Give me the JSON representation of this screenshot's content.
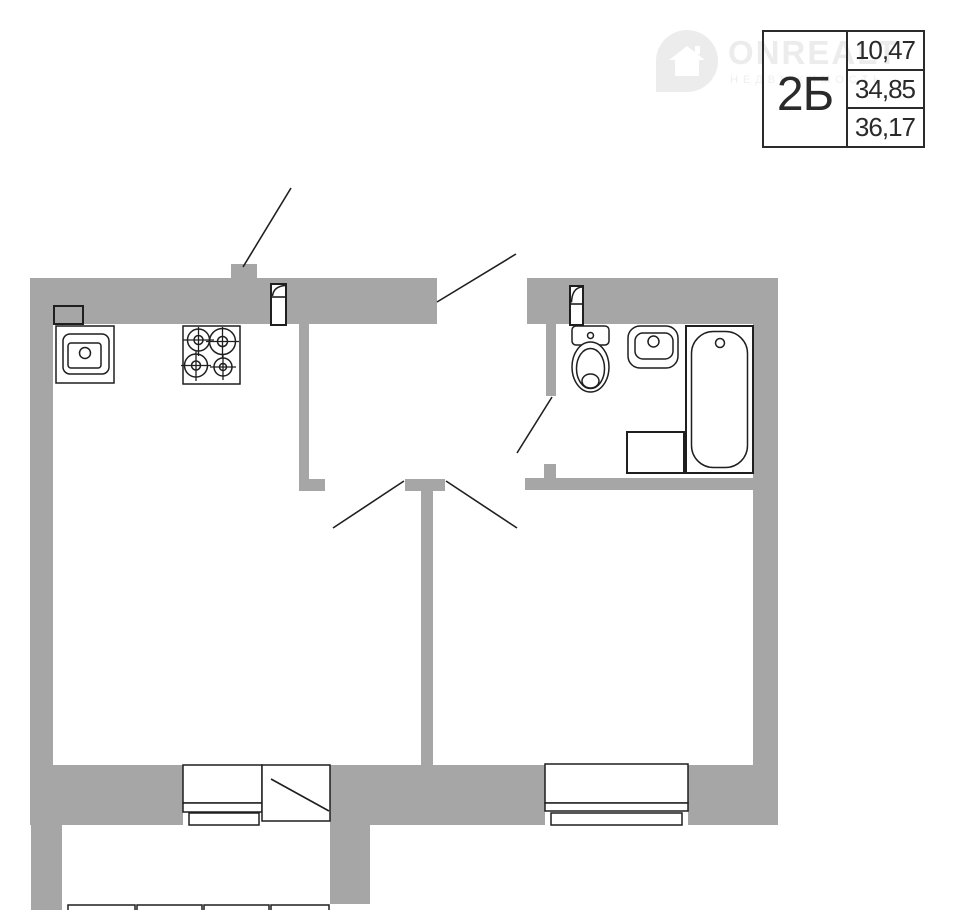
{
  "watermark": {
    "brand": "ONREALT",
    "subtitle": "НЕДВИЖИМОСТЬ"
  },
  "info_table": {
    "unit_label": "2Б",
    "areas": [
      "10,47",
      "34,85",
      "36,17"
    ]
  },
  "colors": {
    "wall": "#a6a6a6",
    "outline": "#1f1f1f",
    "watermark": "#ececec",
    "background": "#ffffff",
    "text": "#2a2a2a"
  },
  "fixtures": [
    "vent-duct",
    "kitchen-sink",
    "gas-stove",
    "wall-door-symbol-kitchen",
    "wall-door-symbol-bathroom",
    "toilet",
    "washbasin",
    "washing-machine",
    "bathtub",
    "kitchen-window",
    "balcony-door",
    "living-room-window",
    "balcony-railing",
    "entrance-opening",
    "door-swing-callouts"
  ]
}
